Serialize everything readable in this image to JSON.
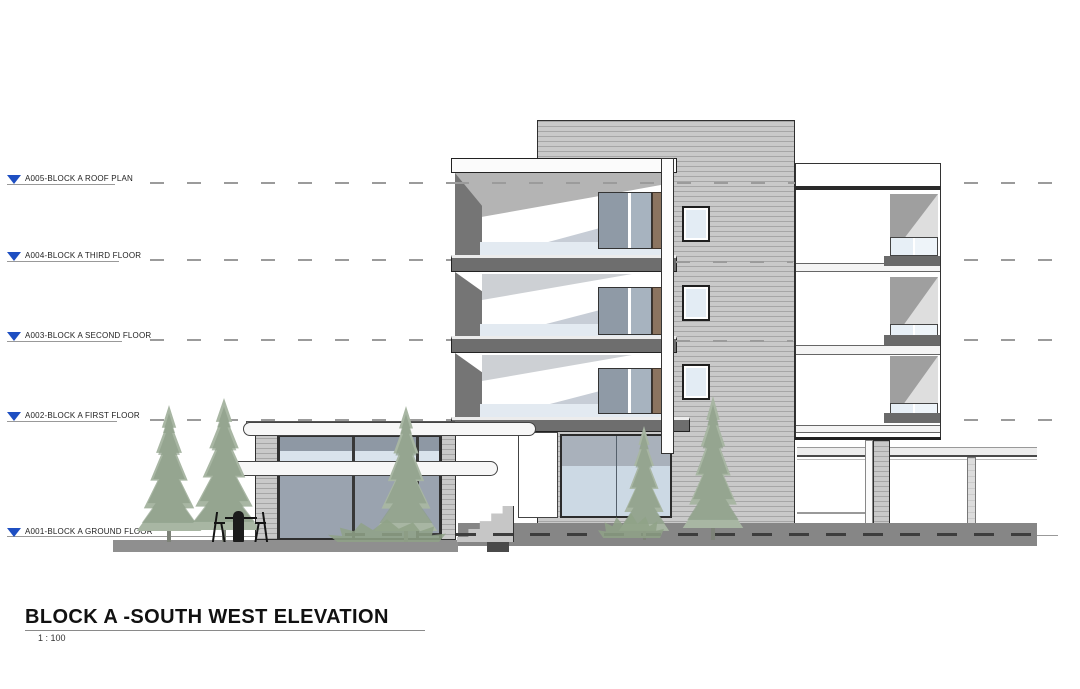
{
  "title": {
    "text": "BLOCK A -SOUTH WEST ELEVATION",
    "scale": "1 : 100"
  },
  "levels": [
    {
      "id": "A005",
      "label": "A005-BLOCK A ROOF PLAN"
    },
    {
      "id": "A004",
      "label": "A004-BLOCK A THIRD FLOOR"
    },
    {
      "id": "A003",
      "label": "A003-BLOCK A SECOND FLOOR"
    },
    {
      "id": "A002",
      "label": "A002-BLOCK A FIRST FLOOR"
    },
    {
      "id": "A001",
      "label": "A001-BLOCK A GROUND FLOOR"
    }
  ],
  "icons": {
    "level_marker": "triangle-down"
  },
  "colors": {
    "marker_blue": "#1e4fc2",
    "siding_gray": "#c9c9c9",
    "slab_gray": "#6e6e6e",
    "glass_dark": "#939daa",
    "glass_light": "#d9e3ec",
    "wood_brown": "#8b7460",
    "ground_gray": "#8a8a8a",
    "foliage_green": "#a3b2a0"
  }
}
